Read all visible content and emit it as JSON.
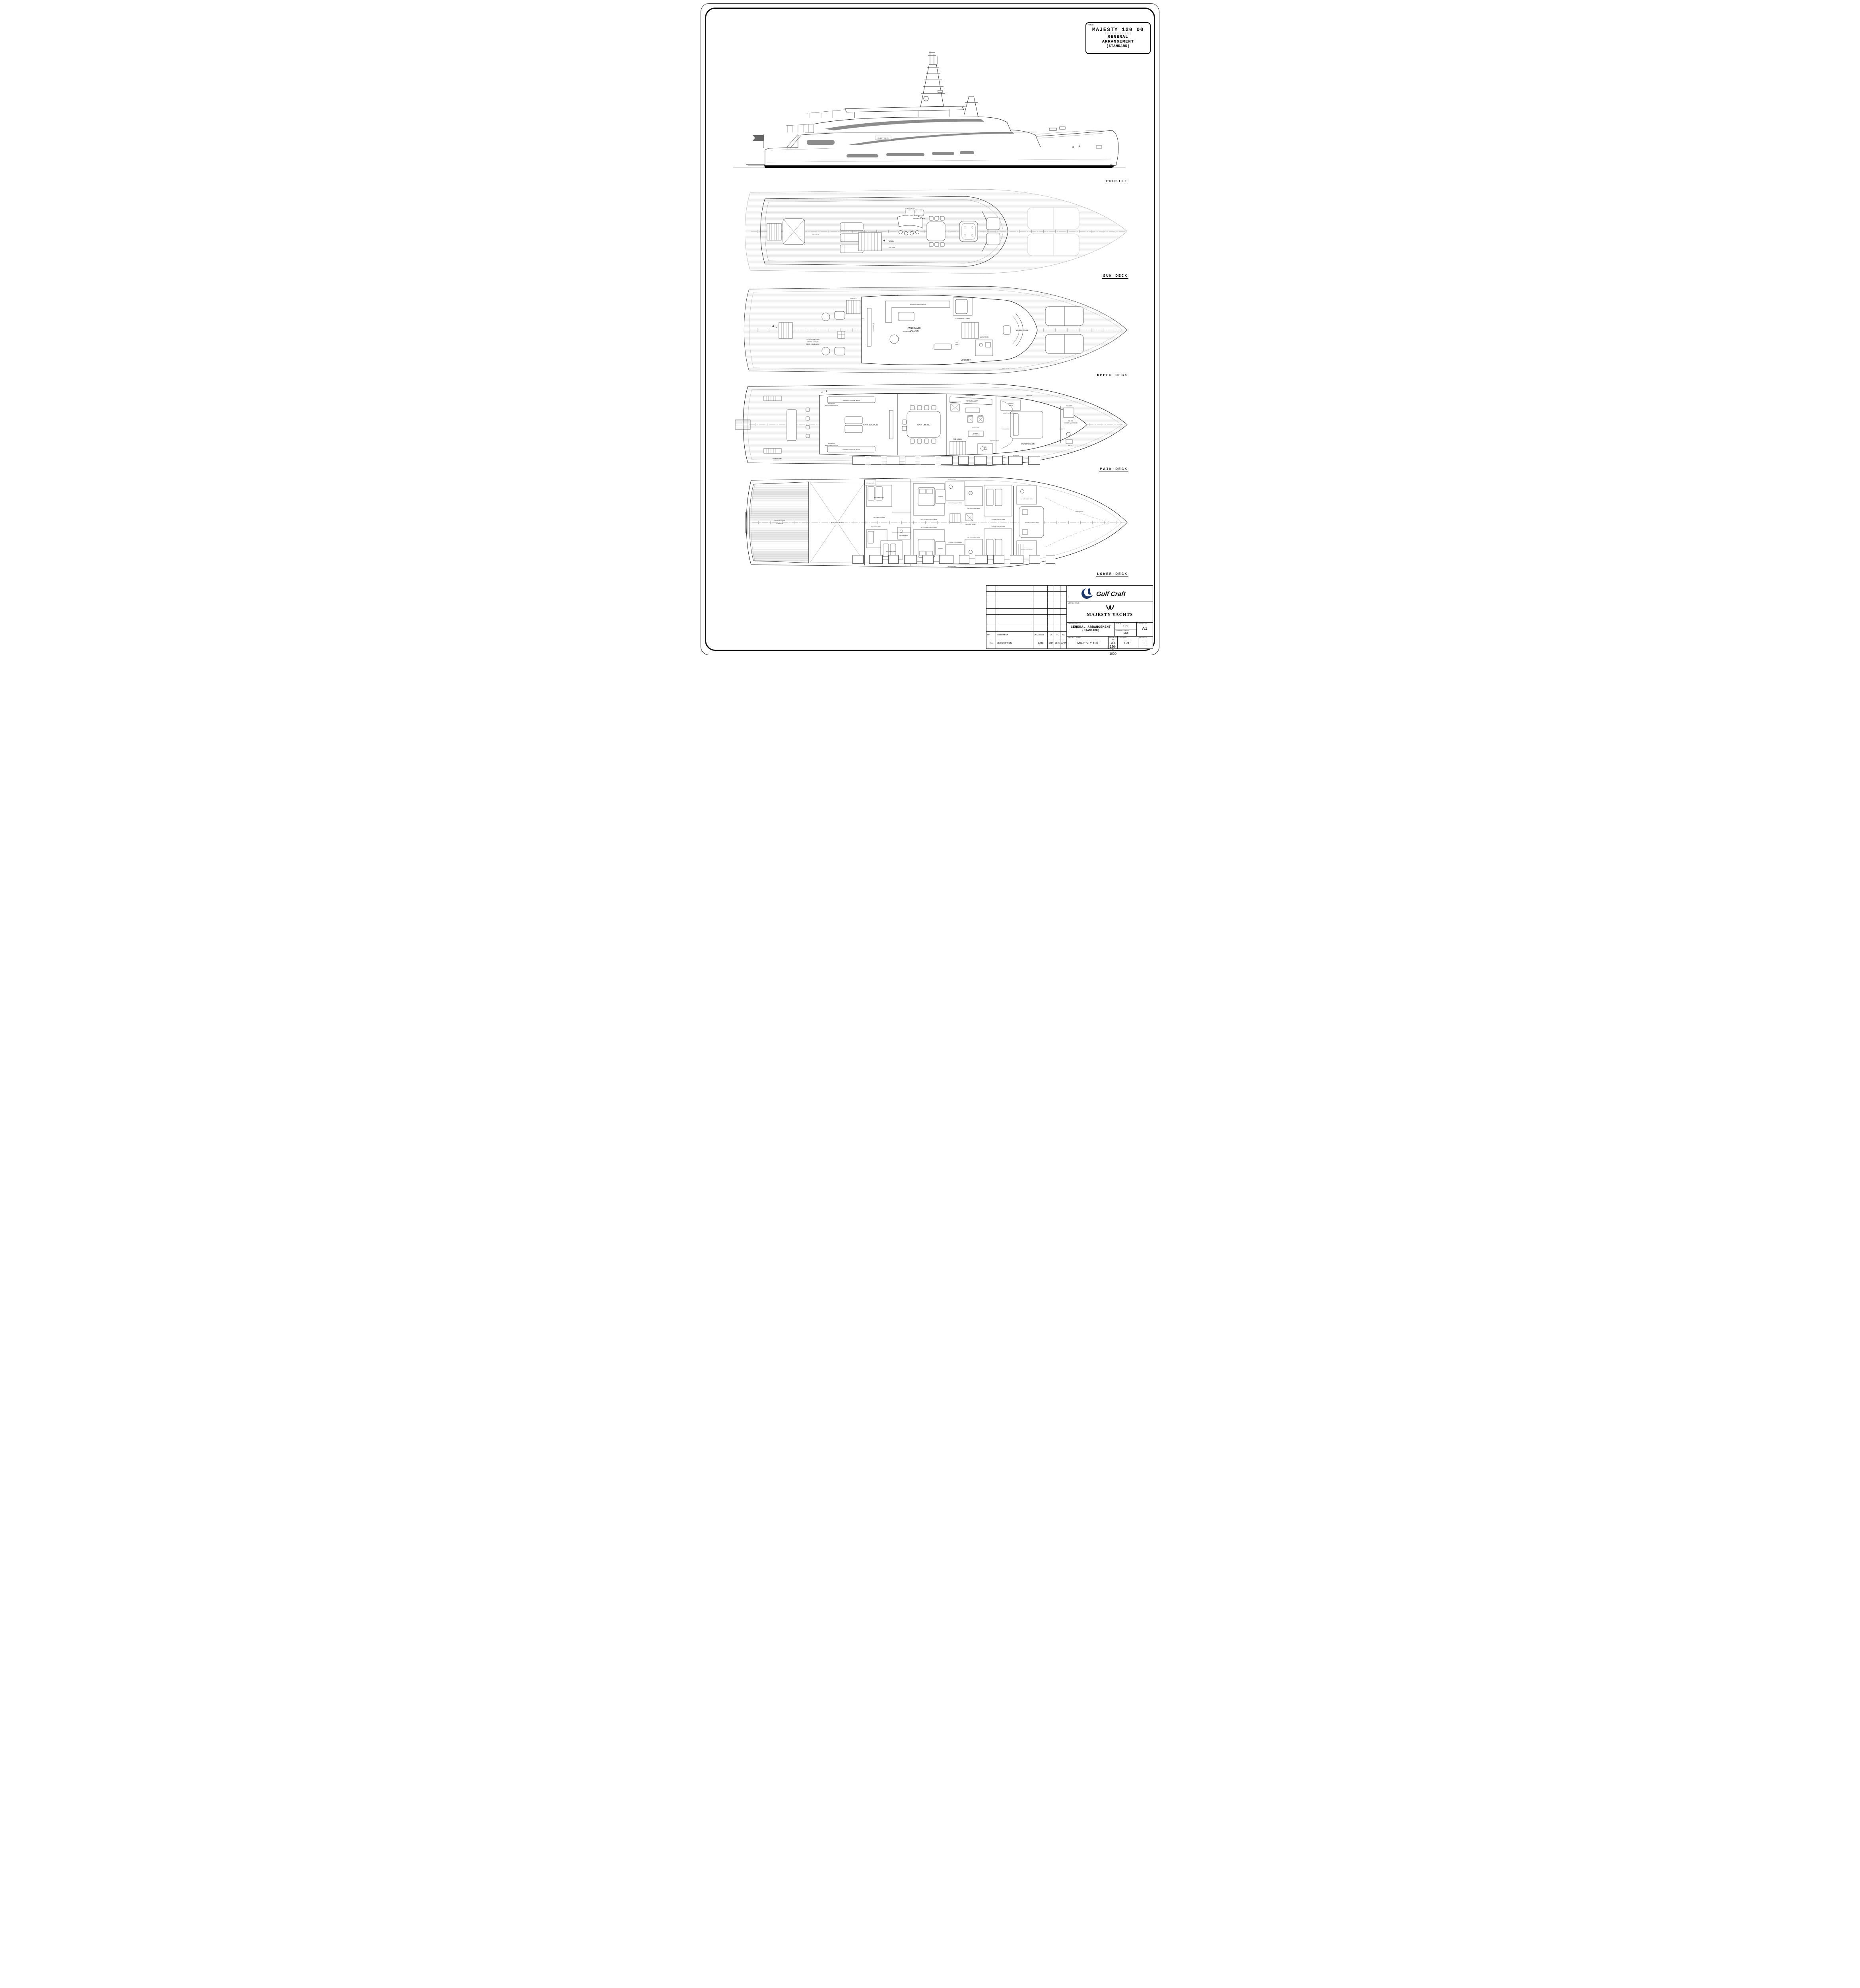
{
  "sheet": {
    "corner_title": {
      "field_label": "TITLE:",
      "model": "MAJESTY 120 00",
      "divider": "----------------",
      "line1": "GENERAL",
      "line2": "ARRANGEMENT",
      "line3": "(STANDARD)"
    },
    "deck_labels": {
      "profile": "PROFILE",
      "sun": "SUN DECK",
      "upper": "UPPER DECK",
      "main": "MAIN DECK",
      "lower": "LOWER DECK"
    }
  },
  "profile": {
    "waterline": "W.L",
    "hull_plate": "MAJESTY YACHTS"
  },
  "sun_deck": {
    "down": "DOWN",
    "kids_gate": "KIDS GATE",
    "ice_maker": "ICE MAKER BELOW",
    "refrigerator": "REFRIGERATOR BELOW"
  },
  "upper_deck": {
    "ps1": "PANORAMIC",
    "ps2": "SALOON",
    "captains_cabin": "CAPTAIN'S CABIN",
    "bathroom": "BATHROOM",
    "dh1": "DAY",
    "dh2": "HEAD",
    "ud_lobby": "UD LOBBY",
    "wheel_house": "WHEEL HOUSE",
    "lf1": "LOOSE FURNITURE",
    "lf2": "CAN BE USED IN",
    "lf3": "BEACH CLUB ALSO",
    "sofa_note": "SOFA WITH STORAGE BELOW",
    "tv_note": "55 INCH LED TV",
    "storage_note": "STORAGE WITH DRAWERS BELOW",
    "book_matched": "BOOK MATCHED",
    "kids_gate": "KIDS GATE",
    "up": "UP",
    "dn": "DN"
  },
  "main_deck": {
    "main_saloon": "MAIN SALOON",
    "main_dining": "MAIN DINING",
    "main_galley": "MAIN GALLEY",
    "p1": "PANTRY",
    "p2": "AREA",
    "md_lobby": "MD LOBBY",
    "dh1": "DAY",
    "dh2": "HEAD",
    "owners_cabin": "OWNER'S CABIN",
    "ob1": "MD 206",
    "ob2": "OWNER BATHROOM",
    "shower": "SHOWER",
    "toilet": "TOILET",
    "sofa_note": "SOFA WITH STORAGE BELOW",
    "ev1": "SPACE FOR",
    "ev2": "ENGINE VENTILATION",
    "washer": "2 WASHER",
    "dryer": "2 DRYER",
    "ss1": "STORAGE",
    "ss2": "WITH SHELVES",
    "vinyl_floor": "VINYL FLOOR",
    "ups": "UPS",
    "battery": "BATTERY",
    "ts1": "TECHNICAL",
    "ts2": "SPACE",
    "mirror_tv": "MIRROR TV",
    "fridge": "FRIDGE-FREEZER COMBI",
    "dishwasher": "DISHWASHER BELOW",
    "sink_note": "SINK WITH WASTE BIN BELOW",
    "storage_above": "STORAGE ABOVE",
    "ice_maker": "ICE MAKER BELOW",
    "sf1": "SPACE FOR FUEL &",
    "sf2": "WATER STATION",
    "up": "UP",
    "kids_gate": "KIDS GATE"
  },
  "lower_deck": {
    "bc1": "BEACH CLUB/",
    "bc2": "GARAGE",
    "engine_room": "ENGINE ROOM",
    "c001": "001 CREW LOUNGE",
    "c002": "002 CREW CABIN",
    "c004": "004 CREW CABIN",
    "c005": "005 CREW BATH",
    "c006": "006 CREW CABIN",
    "c007": "007 CREW BATH",
    "c108": "108 DOUBLE GUEST CABIN",
    "c109": "109 DOUBLE GUEST BATH",
    "c110": "110 DOUBLE GUEST CABIN",
    "c111": "111 DOUBLE GUEST BATH",
    "c112": "112 TWIN GUEST CABIN",
    "c113": "113 TWIN GUEST BATH",
    "c114": "114 TWIN GUEST CABIN",
    "c115": "115 TWIN GUEST BATH",
    "c116": "116 GUEST LOBBY",
    "c117": "117 FWD GUEST CABIN",
    "c118": "118 FWD GUEST BATH",
    "c119": "119 FWD GUEST WIC",
    "shower": "SHOWER",
    "space_for_pipes": "SPACE FOR PIPES",
    "ld_floor_line": "LD FLOOR LINE"
  },
  "title_block": {
    "rev_headers": [
      "No.",
      "DESCRIPTION",
      "DATE",
      "DRN",
      "CHKD",
      "APPRD"
    ],
    "rev_row": {
      "no": "00",
      "description": "Standard GA",
      "date": "26/07/2021",
      "drn": "GC",
      "chkd": "GC",
      "apprd": "GC"
    },
    "company": "Gulf Craft",
    "vessel_title_label": "VESSEL TITLE:",
    "brand": "MAJESTY YACHTS",
    "drawing_title_label": "DRAWING TITLE:",
    "drawing_title": "GENERAL ARRANGEMENT",
    "drawing_subtitle": "(STANDARD)",
    "scale_label": "SCALE",
    "scale": "1:75",
    "units_label": "DRAWING UNITS",
    "units": "MM",
    "sheet_size_label": "SHEET SIZE",
    "sheet_size": "A1",
    "project_label": "PROJECT NAME:",
    "project": "MAJESTY 120",
    "drawing_no_label": "DRAWING No.",
    "drawing_no": "GCI-120-00-1000",
    "sheet_no_label": "SHEET No.",
    "sheet_no": "1 of 1",
    "revision_label": "REVISION",
    "revision": "0"
  }
}
